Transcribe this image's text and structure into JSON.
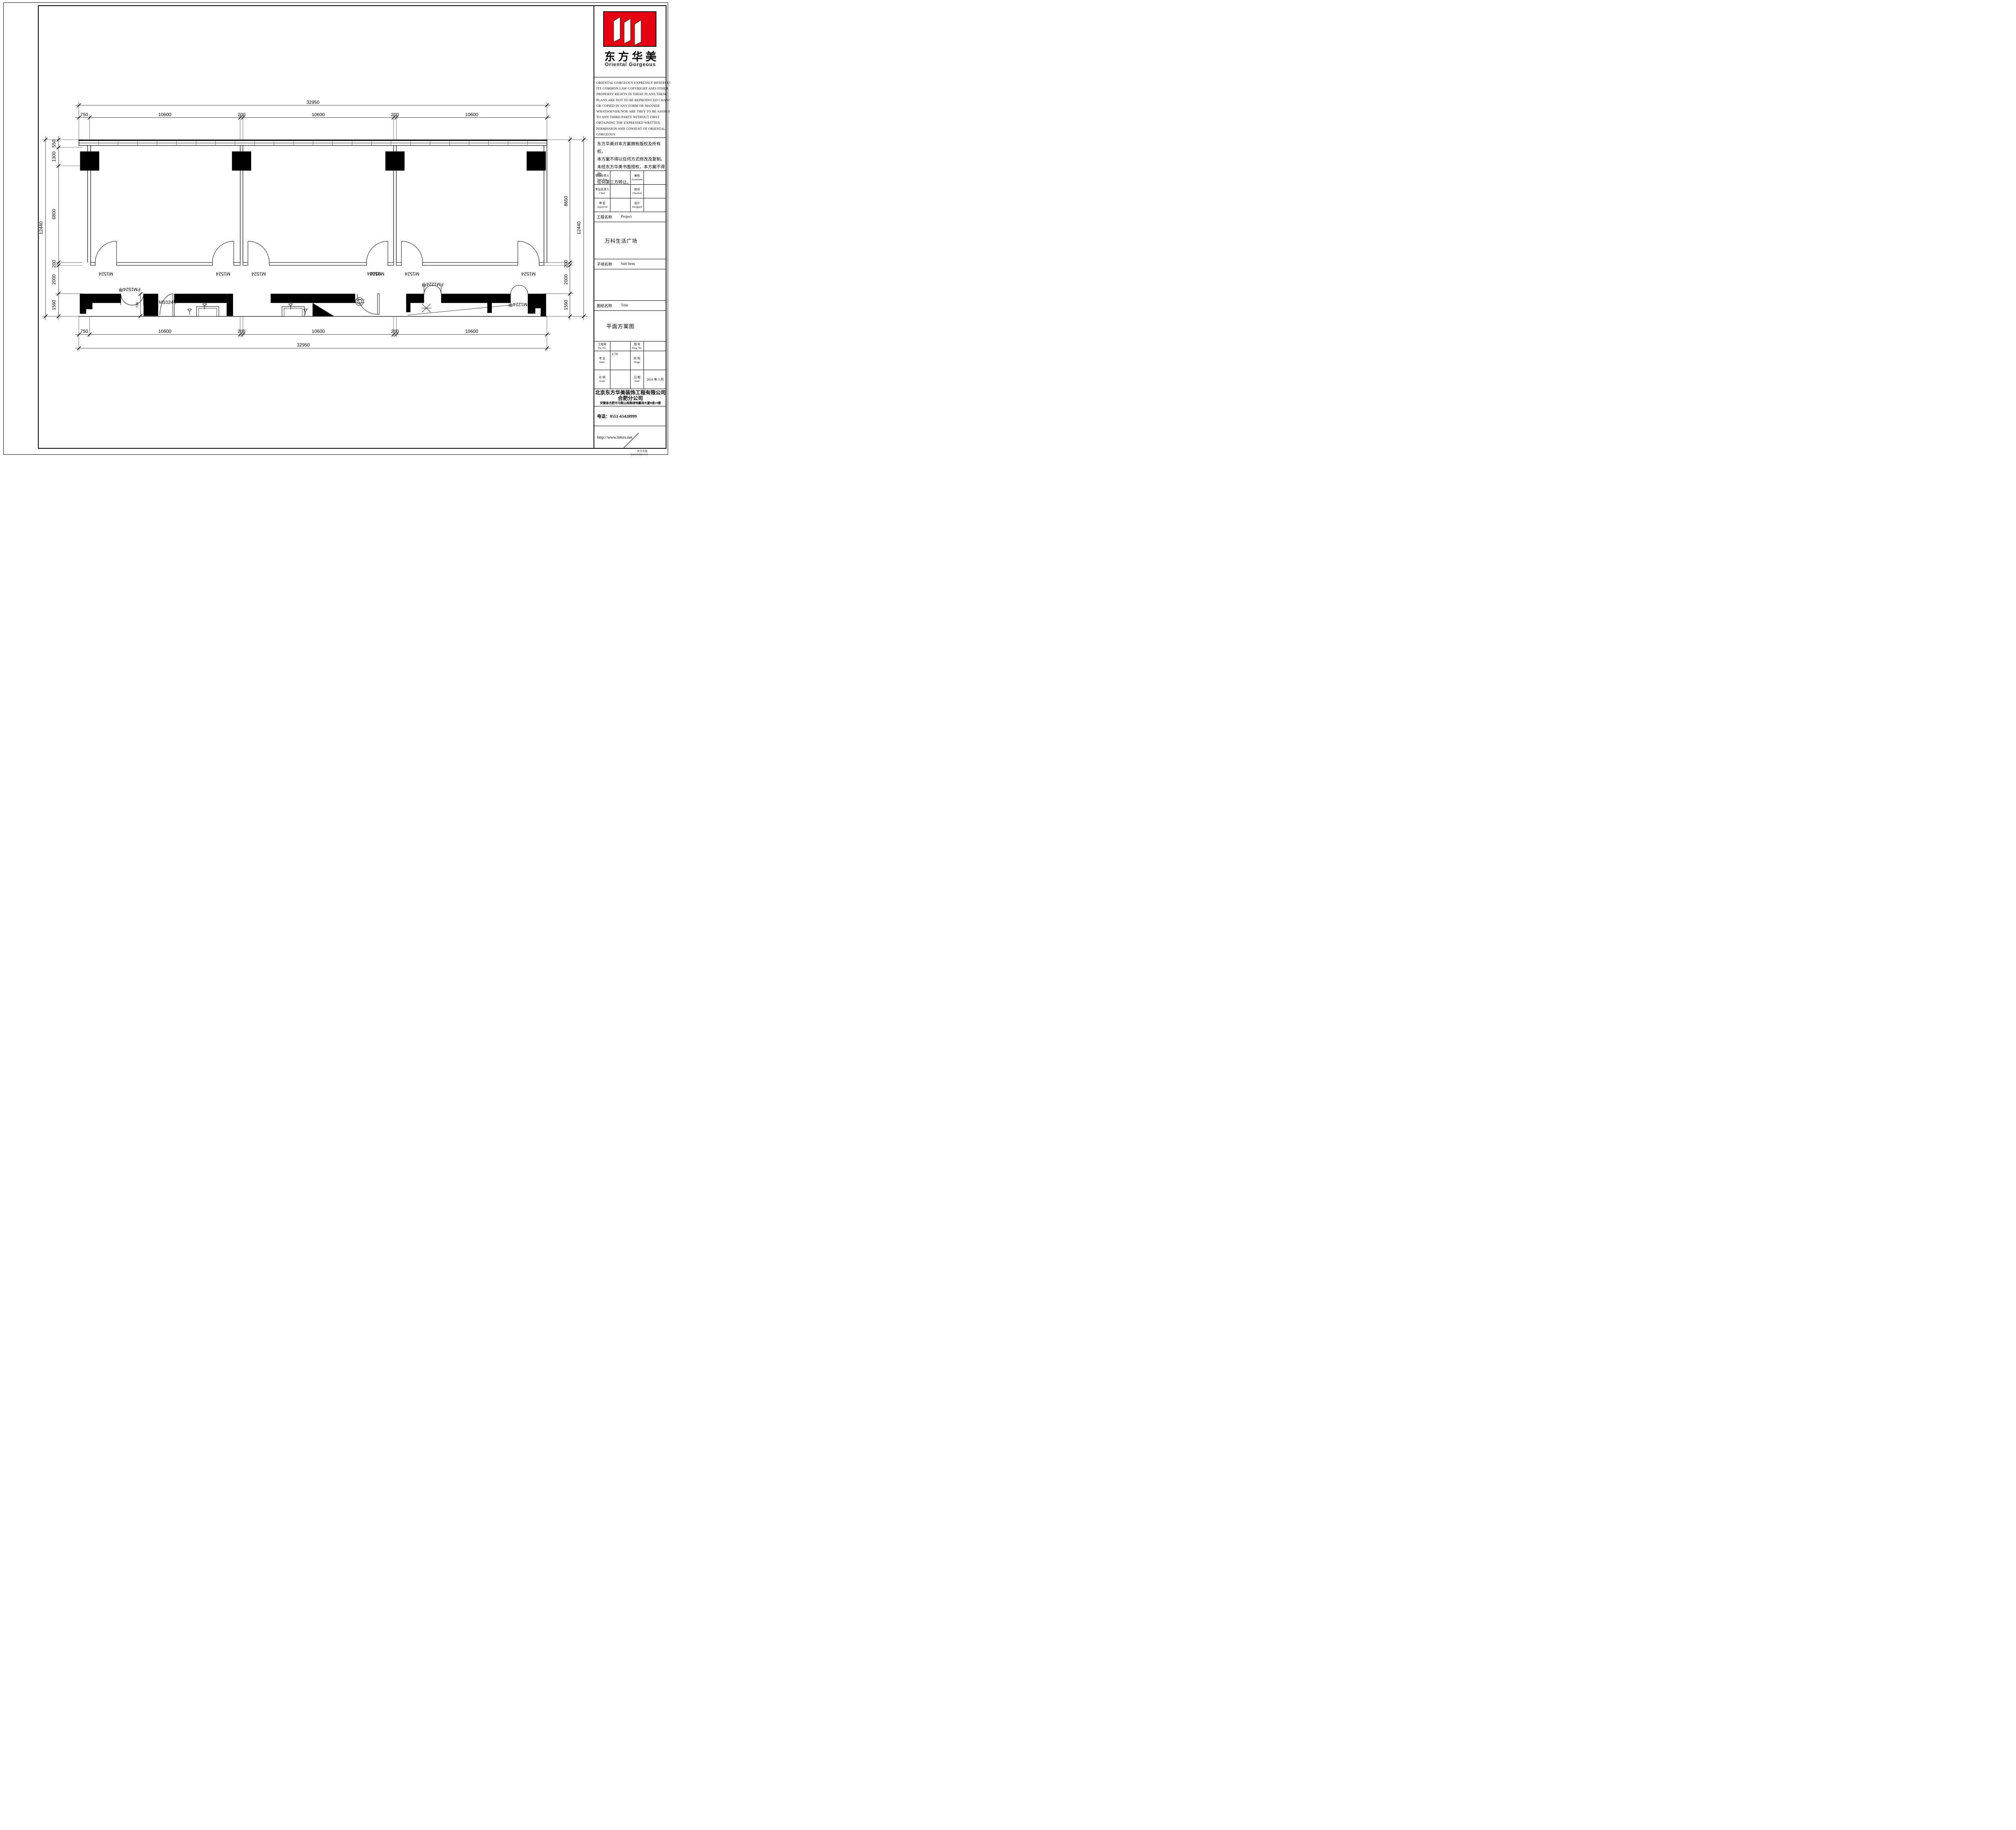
{
  "sheet": {
    "logo": {
      "cn": "东方华美",
      "en": "Oriental  Gorgeous",
      "red": "#e60012"
    },
    "copyright_en": [
      "ORIENTAL GORGEOUS EXPRESSLY RESERVES",
      "ITS COMMON LAW COPYRIGHT AND OTHER",
      "PROPERTY RIGHTS IN THESE PLANS.THESE",
      "PLANS ARE NOT TO BE REPRODUCED CHANGED",
      "OR COPIED IN ANY FORM OR MANNER",
      "WHATSOEVER.NOR ARE THEY TO BE ASSIGHED",
      "TO ANY THIRD PARTY WITHOUT FIRST",
      "OBTAINING THE EXPRESSED WRITTEN",
      "PERMISSION AND CONSENT OF ORIENTAL",
      "GORGEOUS"
    ],
    "copyright_cn": [
      "东方华美对本方案拥有版权及所有权。",
      "本方案不得以任何方式修改及复制。",
      "未经东方华美书面授权，本方案不得向",
      "任何第三方转让。"
    ],
    "personnel": {
      "rows": [
        {
          "label_cn": "项目负责人",
          "label_en": "Item.Prin",
          "value1": "",
          "label2_cn": "审核",
          "label2_en": "Examined",
          "value2": ""
        },
        {
          "label_cn": "专业负责人",
          "label_en": "Chief",
          "value1": "",
          "label2_cn": "校对",
          "label2_en": "Checked",
          "value2": ""
        },
        {
          "label_cn": "审 定",
          "label_en": "Approved",
          "value1": "",
          "label2_cn": "设计",
          "label2_en": "Designed",
          "value2": ""
        }
      ]
    },
    "project": {
      "label_cn": "工程名称",
      "label_en": "Project",
      "value": "万科生活广场"
    },
    "subitem": {
      "label_cn": "子项名称",
      "label_en": "Sub Item",
      "value": ""
    },
    "title": {
      "label_cn": "图纸名称",
      "label_en": "Title",
      "value": "平面方案图"
    },
    "meta": {
      "pjt": {
        "cn": "工程号",
        "en": "Pjt .No.",
        "value": ""
      },
      "dwg": {
        "cn": "图 号",
        "en": "Dwg. No.",
        "value": ""
      },
      "dept": {
        "cn": "专 业",
        "en": "Dept.",
        "value": "1:70"
      },
      "stage": {
        "cn": "阶 段",
        "en": "Stage",
        "value": ""
      },
      "scale": {
        "cn": "比 例",
        "en": "Scale",
        "value": ""
      },
      "date": {
        "cn": "日 期",
        "en": "Date",
        "value": "2016 年 3  月"
      }
    },
    "company": {
      "name": "北京东方华美装饰工程有限公司",
      "branch": "合肥分公司",
      "address": "安徽省合肥市马鞍山南路绿地赢海大厦B座19楼",
      "tel": "电话：0551-65428999",
      "web": "http://www.hmzs.net"
    },
    "watermark": {
      "line1": "东方华美",
      "line2": "www.hmzs.net"
    }
  },
  "plan": {
    "dims": {
      "top_total": "32950",
      "top_segs": [
        "750",
        "10600",
        "200",
        "10600",
        "200",
        "10600"
      ],
      "bottom_segs": [
        "750",
        "10600",
        "200",
        "10600",
        "200",
        "10600"
      ],
      "bottom_total": "32950",
      "left_segs": [
        "550",
        "1300",
        "6800",
        "200",
        "2000",
        "1590"
      ],
      "left_total": "12440",
      "right_segs": [
        "8650",
        "200",
        "2000",
        "1590"
      ],
      "right_total": "12440",
      "door_dim": "738"
    },
    "labels": {
      "m1524": "M1524",
      "fm1524": "FM1524甲",
      "fm1024": "FM1024甲",
      "m1024": "M1024",
      "fm1224": "FM1224甲"
    }
  }
}
